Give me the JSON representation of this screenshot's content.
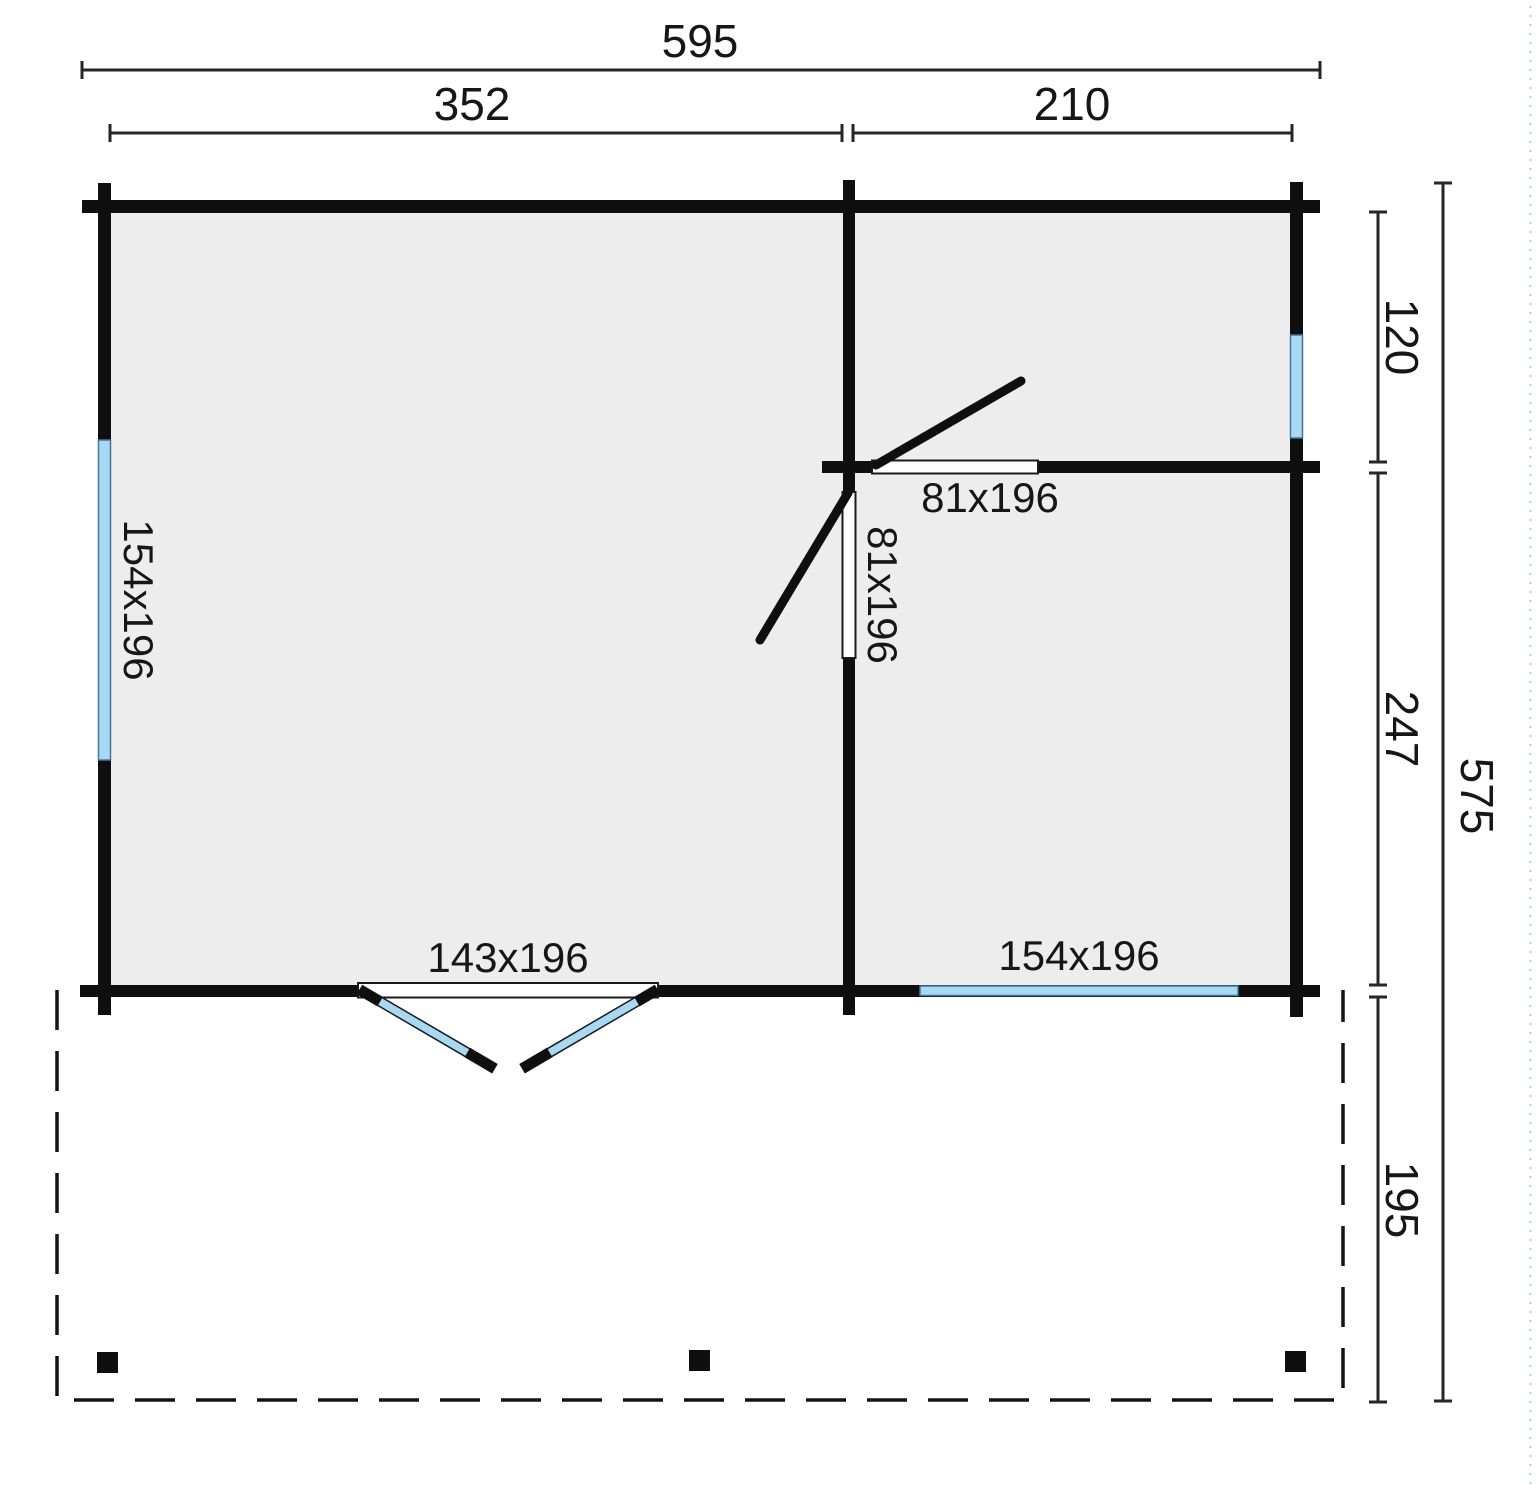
{
  "drawing": {
    "kind": "garden-house floor plan with terrace",
    "dimensions": {
      "top": {
        "overall": "595",
        "left_section": "352",
        "right_section": "210"
      },
      "right": {
        "top_room": "120",
        "bottom_room": "247",
        "terrace": "195",
        "overall": "575"
      }
    },
    "openings": {
      "left_window_label": "154x196",
      "front_window_label": "154x196",
      "front_double_door_label": "143x196",
      "interior_door_horizontal_label": "81x196",
      "interior_door_vertical_label": "81x196"
    }
  },
  "colors": {
    "wall": "#0f0f0f",
    "floor": "#eeedee",
    "window_glass": "#a8d9f2",
    "window_glass_border": "#44769b",
    "opening_fill": "#ffffff",
    "opening_outline": "#1a1a1a",
    "dimension_line": "#262626",
    "text": "#161616",
    "terrace_outline": "#141414",
    "edge_artifact": "#8fbfba"
  }
}
